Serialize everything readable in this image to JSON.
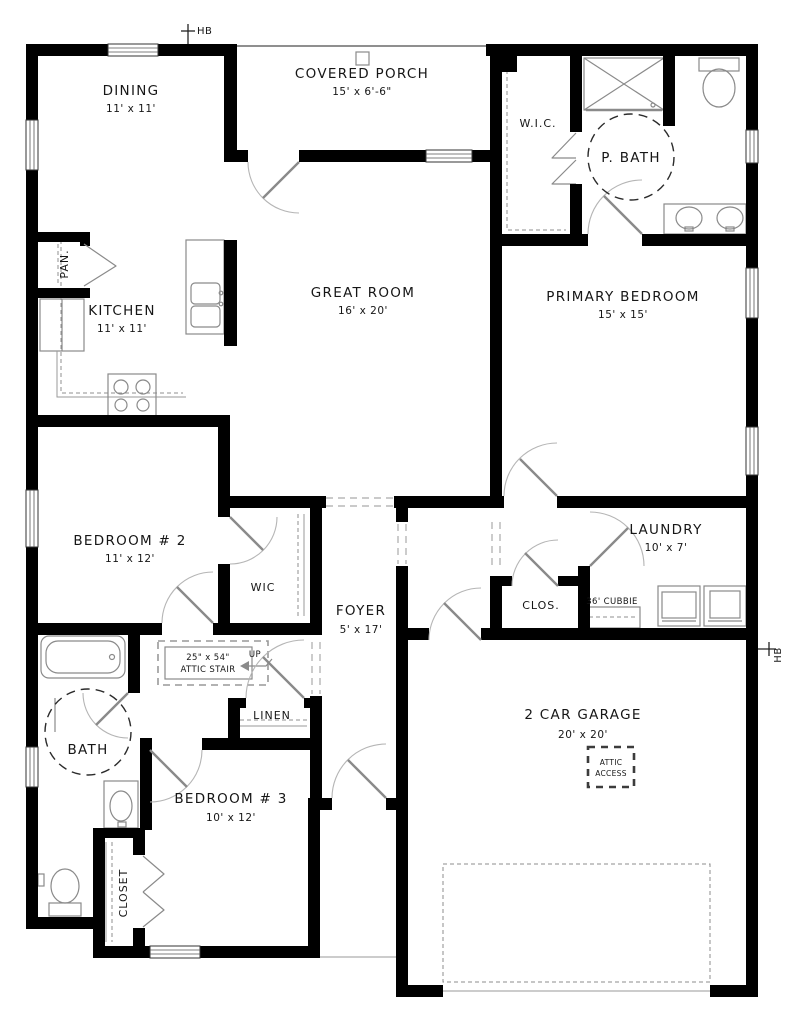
{
  "plan": {
    "markers": {
      "hose_bib": "HB"
    },
    "rooms": {
      "dining": {
        "name": "DINING",
        "dims": "11' x 11'"
      },
      "covered_porch": {
        "name": "COVERED PORCH",
        "dims": "15' x 6'-6\""
      },
      "kitchen": {
        "name": "KITCHEN",
        "dims": "11' x 11'"
      },
      "pantry": {
        "name": "PAN."
      },
      "great_room": {
        "name": "GREAT ROOM",
        "dims": "16' x 20'"
      },
      "primary_bedroom": {
        "name": "PRIMARY BEDROOM",
        "dims": "15' x 15'"
      },
      "wic_primary": {
        "name": "W.I.C."
      },
      "primary_bath": {
        "name": "P. BATH"
      },
      "bedroom2": {
        "name": "BEDROOM # 2",
        "dims": "11' x 12'"
      },
      "wic_bedroom2": {
        "name": "WIC"
      },
      "foyer": {
        "name": "FOYER",
        "dims": "5' x 17'"
      },
      "laundry": {
        "name": "LAUNDRY",
        "dims": "10' x 7'"
      },
      "closet_hall": {
        "name": "CLOS."
      },
      "cubbie": {
        "name": "36' CUBBIE"
      },
      "attic_stair": {
        "line1": "25\" x 54\"",
        "line2": "ATTIC STAIR"
      },
      "up": {
        "name": "UP"
      },
      "bath": {
        "name": "BATH"
      },
      "linen": {
        "name": "LINEN"
      },
      "bedroom3": {
        "name": "BEDROOM # 3",
        "dims": "10' x 12'"
      },
      "closet_bedroom3": {
        "name": "CLOSET"
      },
      "garage": {
        "name": "2 CAR GARAGE",
        "dims": "20' x 20'"
      },
      "attic_access": {
        "line1": "ATTIC",
        "line2": "ACCESS"
      }
    },
    "colors": {
      "wall": "#000000",
      "fixture_line": "#8a8a8a",
      "text": "#161616",
      "background": "#ffffff"
    }
  }
}
